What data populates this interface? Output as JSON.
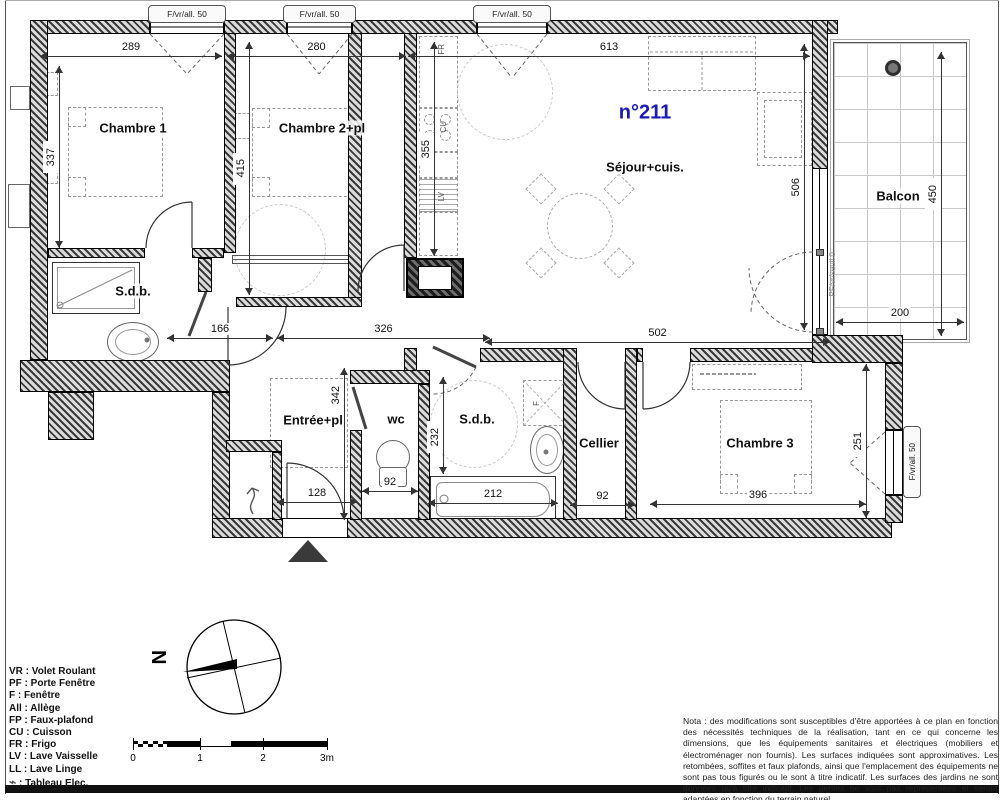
{
  "unit": {
    "number": "n°211"
  },
  "rooms": [
    {
      "id": "chambre-1",
      "label": "Chambre 1",
      "x": 133,
      "y": 128
    },
    {
      "id": "chambre-2",
      "label": "Chambre 2+pl",
      "x": 322,
      "y": 128
    },
    {
      "id": "sejour-cuisine",
      "label": "Séjour+cuis.",
      "x": 645,
      "y": 167
    },
    {
      "id": "balcon",
      "label": "Balcon",
      "x": 898,
      "y": 196
    },
    {
      "id": "sdb-1",
      "label": "S.d.b.",
      "x": 133,
      "y": 291
    },
    {
      "id": "entree",
      "label": "Entrée+pl",
      "x": 313,
      "y": 420
    },
    {
      "id": "wc",
      "label": "wc",
      "x": 396,
      "y": 419
    },
    {
      "id": "sdb-2",
      "label": "S.d.b.",
      "x": 477,
      "y": 419
    },
    {
      "id": "cellier",
      "label": "Cellier",
      "x": 599,
      "y": 443
    },
    {
      "id": "chambre-3",
      "label": "Chambre 3",
      "x": 760,
      "y": 443
    }
  ],
  "appliance_labels": [
    {
      "id": "frigo",
      "label": "FR",
      "x": 433,
      "y": 38
    },
    {
      "id": "cuisson",
      "label": "CU",
      "x": 435,
      "y": 116
    },
    {
      "id": "lave-vaisselle",
      "label": "LV",
      "x": 433,
      "y": 186
    },
    {
      "id": "reserved-spot",
      "label": "F",
      "x": 528,
      "y": 392
    }
  ],
  "window_labels": {
    "top": [
      {
        "label": "F/vr/all. 50",
        "x": 148,
        "w": 78
      },
      {
        "label": "F/vr/all. 50",
        "x": 283,
        "w": 73
      },
      {
        "label": "F/vr/all. 50",
        "x": 473,
        "w": 78
      }
    ],
    "right": {
      "label": "F/vr/all. 50"
    },
    "balcony_door": {
      "label": "PF/vr/seuil 0"
    }
  },
  "dimensions": [
    {
      "value": "289",
      "orient": "h",
      "y": 56,
      "from": 40,
      "to": 222
    },
    {
      "value": "280",
      "orient": "h",
      "y": 56,
      "from": 227,
      "to": 406
    },
    {
      "value": "613",
      "orient": "h",
      "y": 56,
      "from": 408,
      "to": 810
    },
    {
      "value": "337",
      "orient": "v",
      "x": 59,
      "from": 66,
      "to": 248
    },
    {
      "value": "415",
      "orient": "v",
      "x": 249,
      "from": 42,
      "to": 295
    },
    {
      "value": "355",
      "orient": "v",
      "x": 434,
      "from": 42,
      "to": 256
    },
    {
      "value": "506",
      "orient": "v",
      "x": 804,
      "from": 44,
      "to": 330
    },
    {
      "value": "450",
      "orient": "v",
      "x": 941,
      "from": 52,
      "to": 336
    },
    {
      "value": "200",
      "orient": "h",
      "y": 322,
      "from": 836,
      "to": 964
    },
    {
      "value": "166",
      "orient": "h",
      "y": 338,
      "from": 167,
      "to": 273
    },
    {
      "value": "326",
      "orient": "h",
      "y": 338,
      "from": 277,
      "to": 490
    },
    {
      "value": "502",
      "orient": "h",
      "y": 342,
      "from": 485,
      "to": 830
    },
    {
      "value": "342",
      "orient": "v",
      "x": 344,
      "from": 368,
      "to": 520,
      "lp": 0.18
    },
    {
      "value": "232",
      "orient": "v",
      "x": 443,
      "from": 377,
      "to": 474,
      "lp": 0.62
    },
    {
      "value": "92",
      "orient": "h",
      "y": 491,
      "from": 362,
      "to": 418
    },
    {
      "value": "128",
      "orient": "h",
      "y": 502,
      "from": 277,
      "to": 357
    },
    {
      "value": "212",
      "orient": "h",
      "y": 503,
      "from": 428,
      "to": 558
    },
    {
      "value": "92",
      "orient": "h",
      "y": 505,
      "from": 570,
      "to": 635
    },
    {
      "value": "396",
      "orient": "h",
      "y": 504,
      "from": 650,
      "to": 866
    },
    {
      "value": "251",
      "orient": "v",
      "x": 866,
      "from": 364,
      "to": 518
    }
  ],
  "legend": {
    "items": [
      "VR : Volet Roulant",
      "PF : Porte Fenêtre",
      "F : Fenêtre",
      "All : Allège",
      "FP : Faux-plafond",
      "CU : Cuisson",
      "FR : Frigo",
      "LV : Lave Vaisselle",
      "LL : Lave Linge"
    ],
    "elec_symbol": "⌁",
    "elec_label": " : Tableau Elec."
  },
  "compass": {
    "north_label": "N"
  },
  "scale_bar": {
    "tick_labels": [
      "0",
      "1",
      "2",
      "3m"
    ]
  },
  "nota": "Nota : des modifications sont susceptibles d'être apportées à ce plan en fonction des nécessités techniques de la réalisation, tant en ce qui concerne les dimensions, que les équipements sanitaires et électriques (mobiliers et électroménager non fournis). Les surfaces indiquées sont approximatives. Les retombées, soffites et faux plafonds, ainsi que l'emplacement des équipements ne sont pas tous figurés ou le sont à titre indicatif. Les surfaces des jardins ne sont données qu'à titre indicatif. Les pentes ne sont pas représentées et seront adaptées en fonction du terrain naturel.",
  "colors": {
    "unit_number": "#1a1ab8",
    "wall": "#2b2b2b"
  }
}
